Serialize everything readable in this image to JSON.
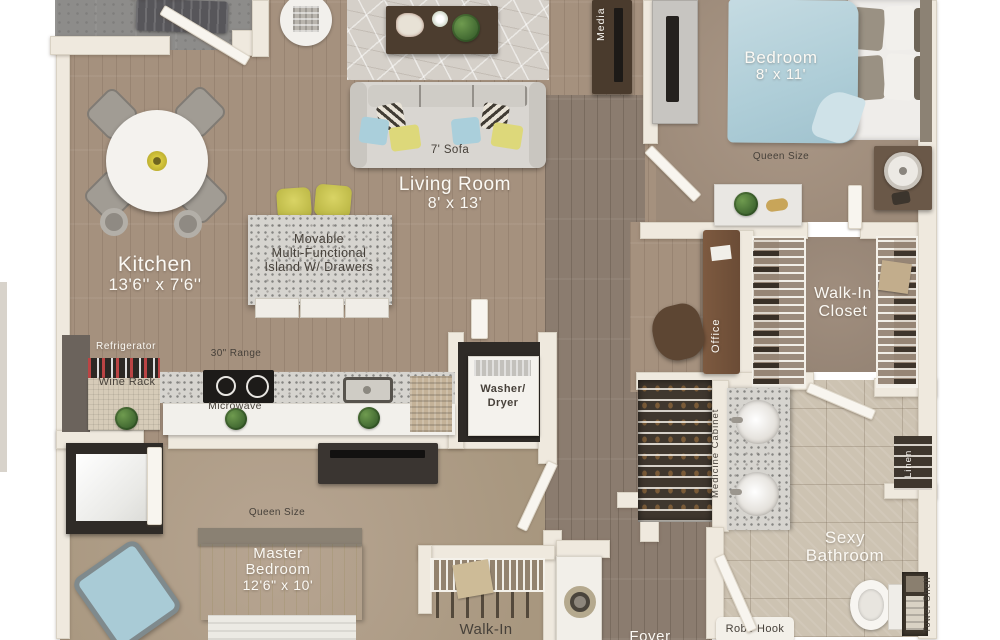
{
  "labels": {
    "balcony_dim": "56' x 16'",
    "kitchen_name": "Kitchen",
    "kitchen_dim": "13'6'' x 7'6''",
    "living_name": "Living Room",
    "living_dim": "8' x 13'",
    "sofa": "7' Sofa",
    "media": "Media",
    "bedroom_name": "Bedroom",
    "bedroom_dim": "8' x 11'",
    "bedroom_bed": "Queen Size",
    "island_l1": "Movable",
    "island_l2": "Multi-Functional",
    "island_l3": "Island W/ Drawers",
    "refrigerator": "Refrigerator",
    "wine_rack": "Wine Rack",
    "range": "30\" Range",
    "microwave": "Microwave",
    "washer_l1": "Washer/",
    "washer_l2": "Dryer",
    "office": "Office",
    "walkin_l1": "Walk-In",
    "walkin_l2": "Closet",
    "medicine_cabinet": "Medicine Cabinet",
    "linen": "Linen",
    "bath_l1": "Sexy",
    "bath_l2": "Bathroom",
    "towel_shelf": "Towel Shelf",
    "robe_hook": "Robe Hook",
    "master_bed_size": "Queen Size",
    "master_l1": "Master",
    "master_l2": "Bedroom",
    "master_dim": "12'6\" x 10'",
    "walkin_master": "Walk-In",
    "foyer": "Foyer"
  },
  "colors": {
    "wall": "#efe9de",
    "wood_floor": "#a5917e",
    "hall_wood": "#8b7c6f",
    "carpet": "#a8977f",
    "bath_tile": "#cdc3b2",
    "balcony_concrete": "#8d8c8a",
    "bed_duvet_blue": "#b7d2da",
    "master_duvet_yellow": "#d5cd6b",
    "stool_yellow": "#ccc751",
    "accent_pillow_blue": "#aacfdb",
    "accent_pillow_yellow": "#ddd87a",
    "dark_furniture": "#4a3b2d"
  }
}
